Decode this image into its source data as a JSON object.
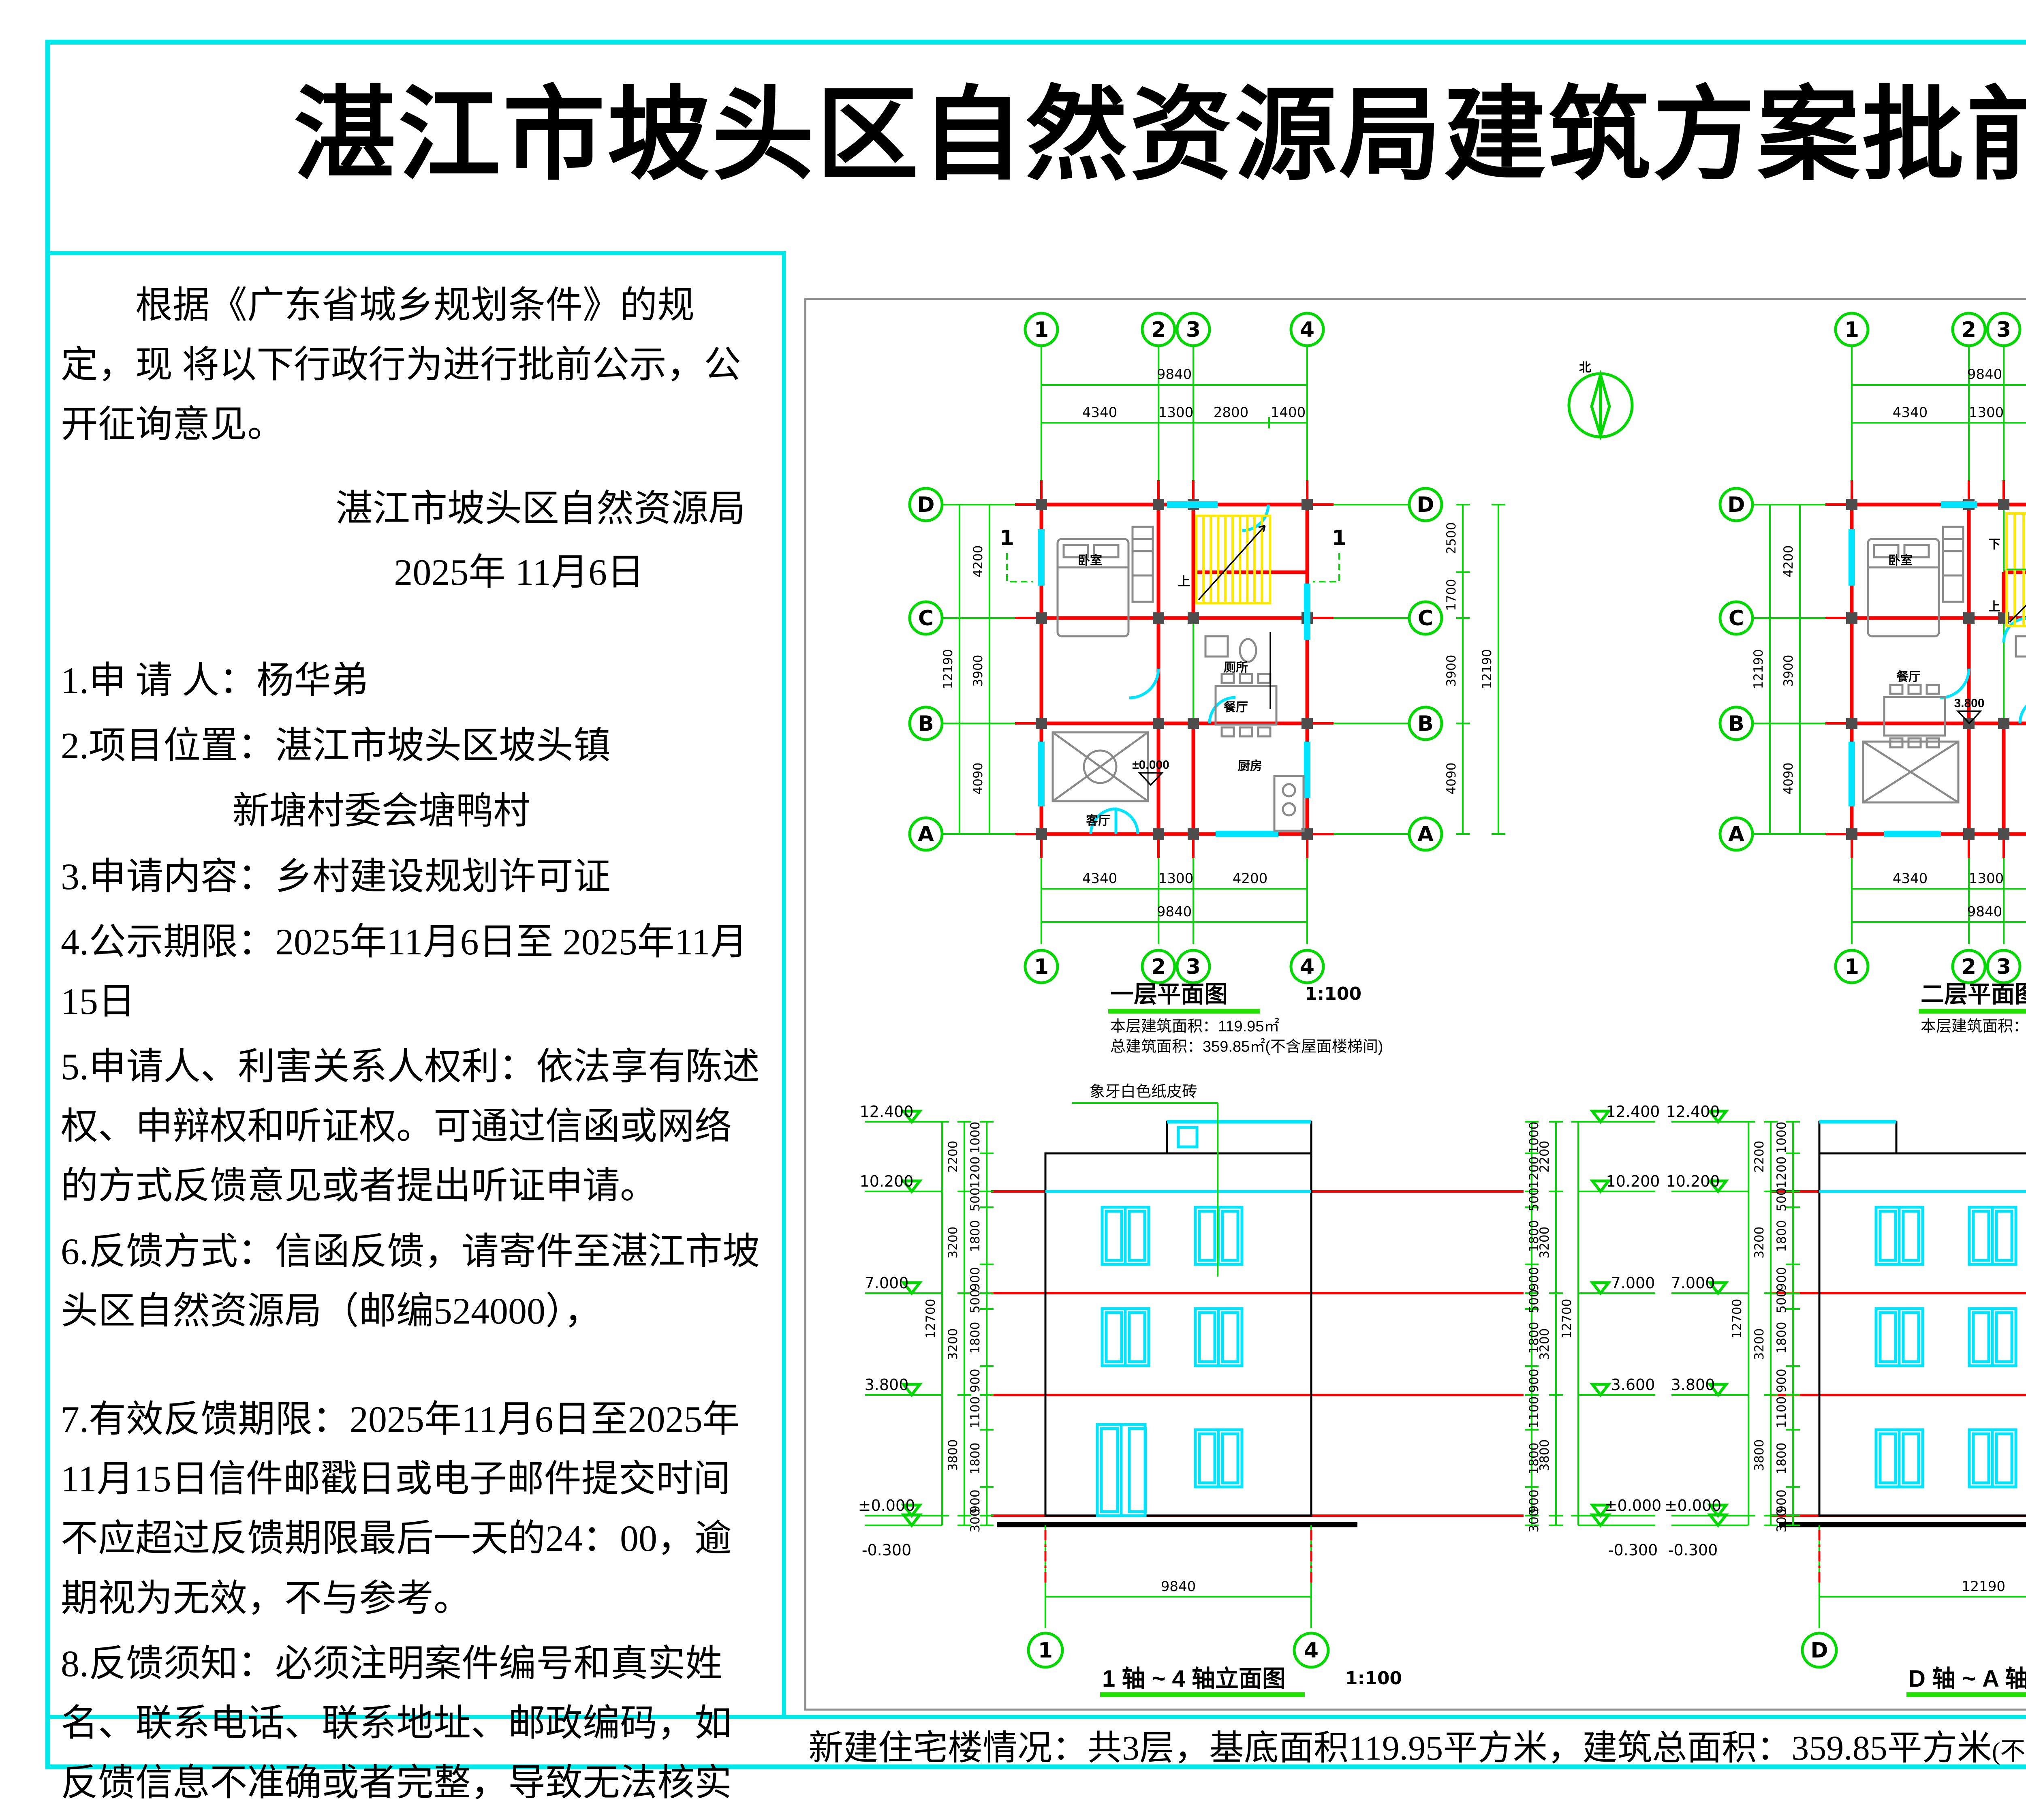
{
  "page": {
    "title": "湛江市坡头区自然资源局建筑方案批前公示",
    "footer_main": "新建住宅楼情况：共3层，基底面积119.95平方米，建筑总面积：359.85平方米",
    "footer_paren": "(不含屋面楼梯间面积)",
    "footer_period": "。"
  },
  "notice": {
    "para1": "根据《广东省城乡规划条件》的规定，现 将以下行政行为进行批前公示，公开征询意见。",
    "org": "湛江市坡头区自然资源局",
    "date": "2025年 11月6日",
    "items": [
      "1.申 请 人：杨华弟",
      "2.项目位置：湛江市坡头区坡头镇",
      "新塘村委会塘鸭村",
      "3.申请内容：乡村建设规划许可证",
      "4.公示期限：2025年11月6日至 2025年11月 15日",
      "5.申请人、利害关系人权利：依法享有陈述权、申辩权和听证权。可通过信函或网络的方式反馈意见或者提出听证申请。",
      "6.反馈方式：信函反馈，请寄件至湛江市坡头区自然资源局（邮编524000），",
      "7.有效反馈期限：2025年11月6日至2025年11月15日信件邮戳日或电子邮件提交时间不应超过反馈期限最后一天的24：00，逾期视为无效，不与参考。",
      "8.反馈须知：必须注明案件编号和真实姓名、联系电话、联系地址、邮政编码，如反馈信息不准确或者完整，导致无法核实有关情况的视为无效。"
    ]
  },
  "drawings": {
    "plan1": {
      "caption": "一层平面图",
      "scale": "1:100",
      "note1": "本层建筑面积：119.95㎡",
      "note2": "总建筑面积：359.85㎡(不含屋面楼梯间)",
      "ax1": "1",
      "ax2": "2",
      "ax3": "3",
      "ax4": "4",
      "axD": "D",
      "axC": "C",
      "axB": "B",
      "axA": "A",
      "top_total": "9840",
      "t1": "4340",
      "t2": "1300",
      "t3": "2800",
      "t4": "1400",
      "b1": "4340",
      "b2": "1300",
      "b3": "4200",
      "bottom_total": "9840",
      "l1": "4200",
      "l2": "3900",
      "l3": "4090",
      "left_total": "12190",
      "r1": "2500",
      "r2": "1700",
      "r3": "3900",
      "r4": "4090",
      "right_total": "12190",
      "room_bedroom": "卧室",
      "room_toilet": "厕所",
      "room_living": "客厅",
      "room_dining": "餐厅",
      "room_kitchen": "厨房",
      "level": "±0.000",
      "up": "上",
      "sec": "1",
      "north": "北"
    },
    "plan2": {
      "caption": "二层平面图",
      "scale": "1:100",
      "note1": "本层建筑面积：119.95㎡",
      "ax1": "1",
      "ax2": "2",
      "ax3": "3",
      "ax4": "4",
      "axD": "D",
      "axC": "C",
      "axB": "B",
      "axA": "A",
      "top_total": "9840",
      "t1": "4340",
      "t2": "1300",
      "t3": "4200",
      "b1": "4340",
      "b2": "1300",
      "b3": "4200",
      "bottom_total": "9840",
      "l1": "4200",
      "l2": "3900",
      "l3": "4090",
      "left_total": "12190",
      "r1": "2500",
      "r2": "1700",
      "r3": "3900",
      "r4": "4090",
      "right_total": "12190",
      "room_bedroom1": "卧室",
      "room_toilet": "厕所",
      "room_dining": "餐厅",
      "room_bedroom2": "卧室",
      "room_bedroom3": "卧室",
      "level": "3.800",
      "up": "上",
      "down": "下",
      "north": "北"
    },
    "elev1": {
      "caption": "1 轴 ~ 4 轴立面图",
      "scale": "1:100",
      "annotation": "象牙白色纸皮砖",
      "lv1": "12.400",
      "lv2": "10.200",
      "lv3": "7.000",
      "lv4": "3.800",
      "lv4r": "3.600",
      "lv5": "±0.000",
      "lv6": "-0.300",
      "c1": "1000",
      "c2": "1200",
      "c3": "500",
      "c4": "1800",
      "c5": "900",
      "c6": "500",
      "c7": "1800",
      "c8": "900",
      "c9": "1100",
      "c10": "1800",
      "c11": "900",
      "c12": "300",
      "o1": "2200",
      "o2": "3200",
      "o3": "3200",
      "o4": "3800",
      "total": "12700",
      "width": "9840",
      "axl": "1",
      "axr": "4"
    },
    "elev2": {
      "caption": "D 轴 ~ A 轴立面图",
      "scale": "1:100",
      "annotation": "象牙白色纸皮砖",
      "lv1": "12.400",
      "lv2": "10.200",
      "lv3": "7.000",
      "lv4": "3.800",
      "lv5": "±0.000",
      "lv6": "-0.300",
      "c1": "1000",
      "c2": "1200",
      "c3": "500",
      "c4": "1800",
      "c5": "900",
      "c6": "500",
      "c7": "1800",
      "c8": "900",
      "c9": "1100",
      "c10": "1800",
      "c11": "900",
      "c12": "300",
      "o1": "2200",
      "o2": "3200",
      "o3": "3200",
      "o4": "3800",
      "total": "12700",
      "width": "12190",
      "axl": "D",
      "axr": "A"
    }
  }
}
